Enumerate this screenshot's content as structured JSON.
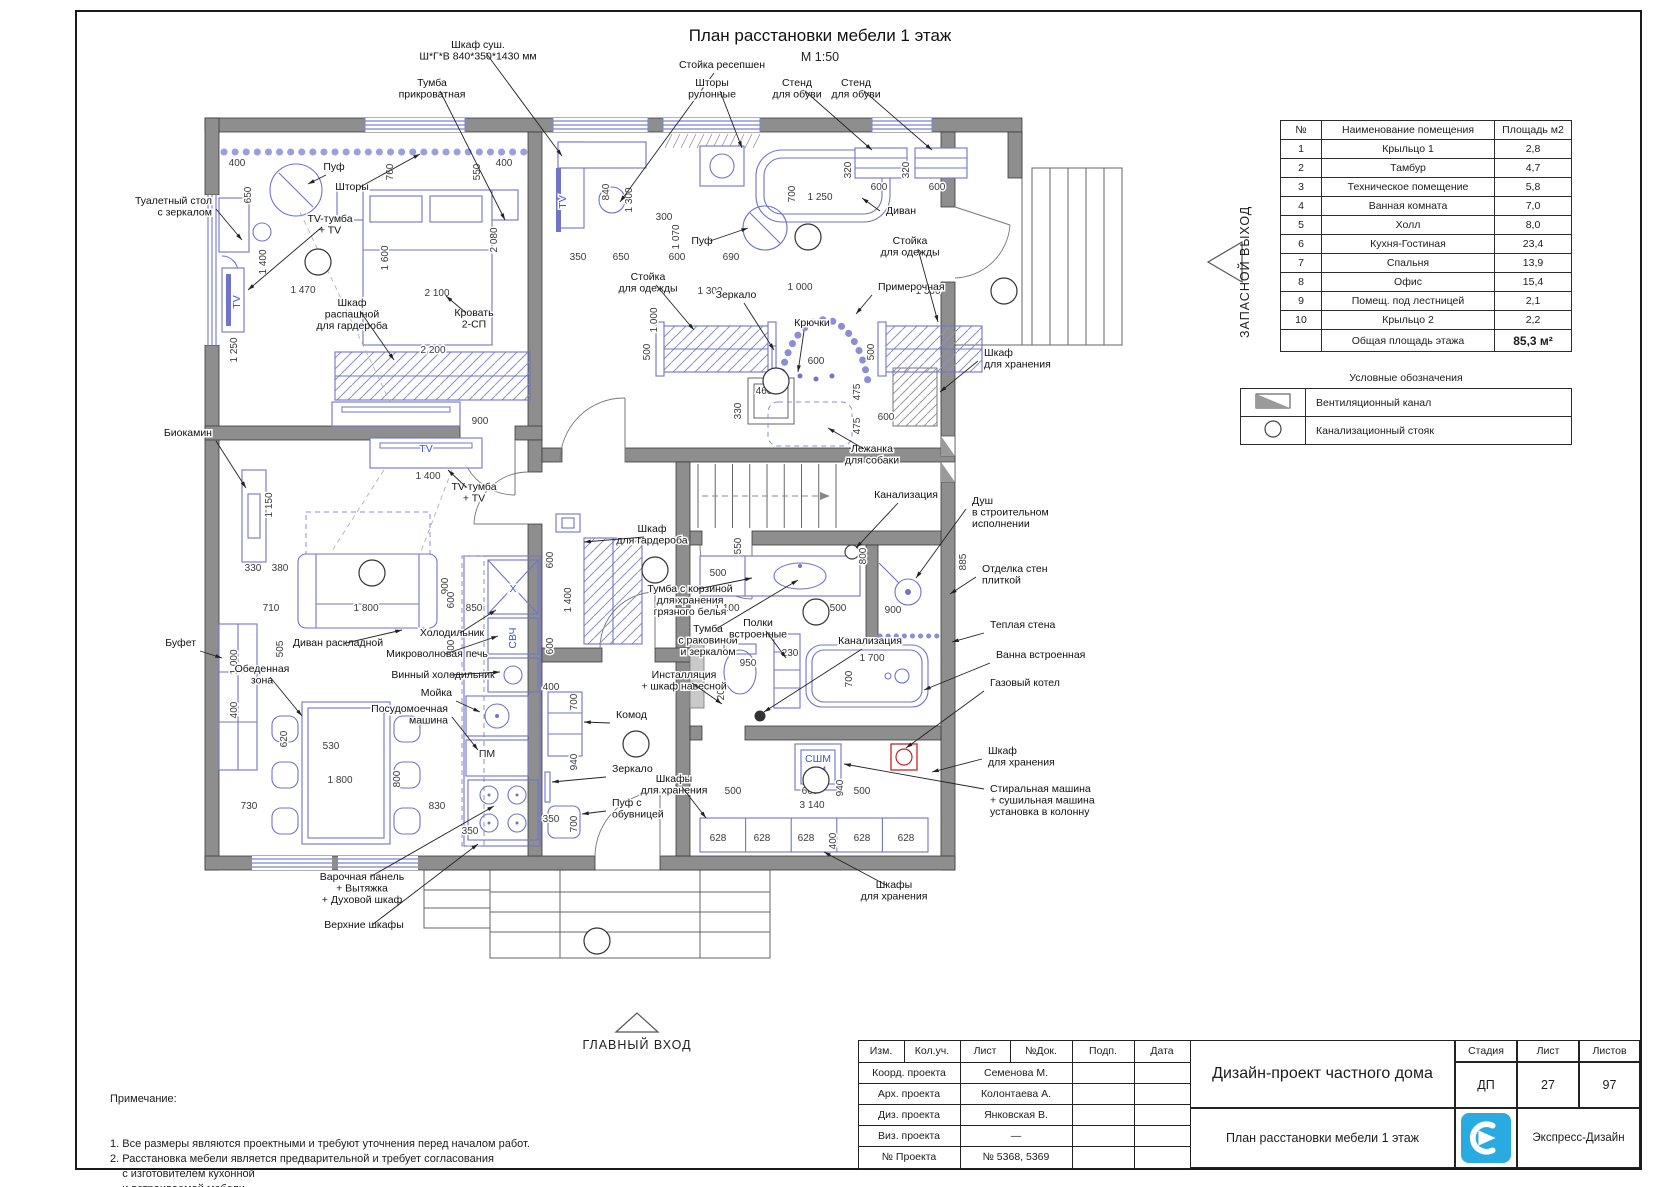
{
  "page": {
    "title": "План расстановки мебели 1 этаж",
    "scale": "М 1:50"
  },
  "arrows": {
    "main_entrance": "ГЛАВНЫЙ ВХОД",
    "emergency_exit": "ЗАПАСНОЙ ВЫХОД"
  },
  "room_table": {
    "headers": [
      "№",
      "Наименование помещения",
      "Площадь м2"
    ],
    "rows": [
      [
        "1",
        "Крыльцо 1",
        "2,8"
      ],
      [
        "2",
        "Тамбур",
        "4,7"
      ],
      [
        "3",
        "Техническое помещение",
        "5,8"
      ],
      [
        "4",
        "Ванная комната",
        "7,0"
      ],
      [
        "5",
        "Холл",
        "8,0"
      ],
      [
        "6",
        "Кухня-Гостиная",
        "23,4"
      ],
      [
        "7",
        "Спальня",
        "13,9"
      ],
      [
        "8",
        "Офис",
        "15,4"
      ],
      [
        "9",
        "Помещ. под лестницей",
        "2,1"
      ],
      [
        "10",
        "Крыльцо 2",
        "2,2"
      ]
    ],
    "total_label": "Общая площадь этажа",
    "total_value": "85,3 м²"
  },
  "legend": {
    "title": "Условные обозначения",
    "items": [
      {
        "symbol": "vent-channel",
        "label": "Вентиляционный канал"
      },
      {
        "symbol": "sewer-riser",
        "label": "Канализационный стояк"
      }
    ]
  },
  "notes": {
    "title": "Примечание:",
    "items": [
      "1. Все размеры являются проектными и требуют уточнения перед началом работ.",
      "2. Расстановка мебели является предварительной и требует согласования",
      "    с изготовителем кухонной",
      "    и встраиваемой мебели.",
      "3. Несоответствия согласовать с автором проекта."
    ]
  },
  "title_block": {
    "header_cols": [
      "Изм.",
      "Кол.уч.",
      "Лист",
      "№Док.",
      "Подп.",
      "Дата"
    ],
    "rows": [
      [
        "Коорд. проекта",
        "Семенова М."
      ],
      [
        "Арх. проекта",
        "Колонтаева А."
      ],
      [
        "Диз. проекта",
        "Янковская В."
      ],
      [
        "Виз. проекта",
        "—"
      ],
      [
        "№ Проекта",
        "№ 5368, 5369"
      ]
    ],
    "project_title": "Дизайн-проект частного дома",
    "stage_label": "Стадия",
    "stage": "ДП",
    "sheet_label": "Лист",
    "sheet": "27",
    "sheets_label": "Листов",
    "sheets": "97",
    "drawing_name": "План расстановки мебели 1 этаж",
    "company": "Экспресс-Дизайн",
    "logo_color": "#29abe2"
  },
  "plan": {
    "room_numbers": [
      {
        "n": "1",
        "x": 597,
        "y": 941
      },
      {
        "n": "2",
        "x": 636,
        "y": 744
      },
      {
        "n": "3",
        "x": 816,
        "y": 780
      },
      {
        "n": "4",
        "x": 816,
        "y": 612
      },
      {
        "n": "5",
        "x": 655,
        "y": 570
      },
      {
        "n": "6",
        "x": 372,
        "y": 573
      },
      {
        "n": "7",
        "x": 318,
        "y": 262
      },
      {
        "n": "8",
        "x": 808,
        "y": 237
      },
      {
        "n": "9",
        "x": 776,
        "y": 381
      },
      {
        "n": "10",
        "x": 1004,
        "y": 291
      }
    ],
    "labels": [
      {
        "t": "Туалетный стол\nс зеркалом",
        "x": 212,
        "y": 204,
        "a": "end",
        "tx": 242,
        "ty": 240
      },
      {
        "t": "Тумба\nприкроватная",
        "x": 432,
        "y": 86,
        "a": "middle",
        "tx": 505,
        "ty": 220
      },
      {
        "t": "Шкаф суш.\nШ*Г*В 840*350*1430 мм",
        "x": 478,
        "y": 48,
        "a": "middle",
        "tx": 562,
        "ty": 156
      },
      {
        "t": "Стойка ресепшен",
        "x": 722,
        "y": 68,
        "a": "middle",
        "tx": 620,
        "ty": 202
      },
      {
        "t": "Шторы\nрулонные",
        "x": 712,
        "y": 86,
        "a": "middle",
        "tx": 742,
        "ty": 148
      },
      {
        "t": "Стенд\nдля обуви",
        "x": 797,
        "y": 86,
        "a": "middle",
        "tx": 872,
        "ty": 150
      },
      {
        "t": "Стенд\nдля обуви",
        "x": 856,
        "y": 86,
        "a": "middle",
        "tx": 932,
        "ty": 150
      },
      {
        "t": "Пуф",
        "x": 334,
        "y": 170,
        "a": "middle",
        "tx": 308,
        "ty": 184
      },
      {
        "t": "Шторы",
        "x": 352,
        "y": 190,
        "a": "middle",
        "tx": 420,
        "ty": 154
      },
      {
        "t": "TV-тумба\n+ TV",
        "x": 330,
        "y": 222,
        "a": "middle",
        "tx": 248,
        "ty": 290
      },
      {
        "t": "Кровать\n2-СП",
        "x": 474,
        "y": 316,
        "a": "middle",
        "tx": 446,
        "ty": 296
      },
      {
        "t": "Шкаф\nраспашной\nдля гардероба",
        "x": 352,
        "y": 306,
        "a": "middle",
        "tx": 394,
        "ty": 360
      },
      {
        "t": "Пуф",
        "x": 702,
        "y": 244,
        "a": "middle",
        "tx": 748,
        "ty": 228
      },
      {
        "t": "Диван",
        "x": 886,
        "y": 214,
        "a": "start",
        "tx": 862,
        "ty": 198
      },
      {
        "t": "Стойка\nдля одежды",
        "x": 648,
        "y": 280,
        "a": "middle",
        "tx": 694,
        "ty": 330
      },
      {
        "t": "Зеркало",
        "x": 736,
        "y": 298,
        "a": "middle",
        "tx": 774,
        "ty": 350
      },
      {
        "t": "Крючки",
        "x": 812,
        "y": 326,
        "a": "middle",
        "tx": 798,
        "ty": 372
      },
      {
        "t": "Примерочная",
        "x": 878,
        "y": 290,
        "a": "start",
        "tx": 856,
        "ty": 314
      },
      {
        "t": "Стойка\nдля одежды",
        "x": 910,
        "y": 244,
        "a": "middle",
        "tx": 938,
        "ty": 322
      },
      {
        "t": "Шкаф\nдля хранения",
        "x": 984,
        "y": 356,
        "a": "start",
        "tx": 940,
        "ty": 392
      },
      {
        "t": "Лежанка\nдля собаки",
        "x": 872,
        "y": 452,
        "a": "middle",
        "tx": 828,
        "ty": 428
      },
      {
        "t": "Канализация",
        "x": 906,
        "y": 498,
        "a": "middle",
        "tx": 856,
        "ty": 548
      },
      {
        "t": "Душ\nв строительном\nисполнении",
        "x": 972,
        "y": 504,
        "a": "start",
        "tx": 916,
        "ty": 578
      },
      {
        "t": "Отделка стен\nплиткой",
        "x": 982,
        "y": 572,
        "a": "start",
        "tx": 950,
        "ty": 594
      },
      {
        "t": "Теплая стена",
        "x": 990,
        "y": 628,
        "a": "start",
        "tx": 952,
        "ty": 642
      },
      {
        "t": "Ванна встроенная",
        "x": 996,
        "y": 658,
        "a": "start",
        "tx": 924,
        "ty": 690
      },
      {
        "t": "Газовый котел",
        "x": 990,
        "y": 686,
        "a": "start",
        "tx": 906,
        "ty": 748
      },
      {
        "t": "Шкаф\nдля хранения",
        "x": 988,
        "y": 754,
        "a": "start",
        "tx": 932,
        "ty": 772
      },
      {
        "t": "Стиральная машина\n+ сушильная машина\nустановка в колонну",
        "x": 990,
        "y": 792,
        "a": "start",
        "tx": 844,
        "ty": 764
      },
      {
        "t": "Шкафы\nдля хранения",
        "x": 894,
        "y": 888,
        "a": "middle",
        "tx": 824,
        "ty": 852
      },
      {
        "t": "Шкафы\nдля хранения",
        "x": 674,
        "y": 782,
        "a": "middle",
        "tx": 706,
        "ty": 818
      },
      {
        "t": "Зеркало",
        "x": 612,
        "y": 772,
        "a": "start",
        "tx": 552,
        "ty": 782
      },
      {
        "t": "Комод",
        "x": 616,
        "y": 718,
        "a": "start",
        "tx": 584,
        "ty": 722
      },
      {
        "t": "Пуф с\nобувницей",
        "x": 612,
        "y": 806,
        "a": "start",
        "tx": 582,
        "ty": 814
      },
      {
        "t": "Шкаф\nдля гардероба",
        "x": 652,
        "y": 532,
        "a": "middle",
        "tx": 584,
        "ty": 542
      },
      {
        "t": "Тумба с корзиной\nдля хранения\nгрязного белья",
        "x": 690,
        "y": 592,
        "a": "middle",
        "tx": 752,
        "ty": 578
      },
      {
        "t": "Тумба\nс раковиной\nи зеркалом",
        "x": 708,
        "y": 632,
        "a": "middle",
        "tx": 798,
        "ty": 580
      },
      {
        "t": "Инсталляция\n+ шкаф навесной",
        "x": 684,
        "y": 678,
        "a": "middle",
        "tx": 722,
        "ty": 704
      },
      {
        "t": "Полки\nвстроенные",
        "x": 758,
        "y": 626,
        "a": "middle",
        "tx": 786,
        "ty": 658
      },
      {
        "t": "Канализация",
        "x": 870,
        "y": 644,
        "a": "middle",
        "tx": 764,
        "ty": 712
      },
      {
        "t": "Биокамин",
        "x": 212,
        "y": 436,
        "a": "end",
        "tx": 246,
        "ty": 488
      },
      {
        "t": "Буфет",
        "x": 196,
        "y": 646,
        "a": "end",
        "tx": 222,
        "ty": 658
      },
      {
        "t": "Обеденная\nзона",
        "x": 262,
        "y": 672,
        "a": "middle",
        "tx": 302,
        "ty": 716
      },
      {
        "t": "Диван раскладной",
        "x": 338,
        "y": 646,
        "a": "middle",
        "tx": 402,
        "ty": 630
      },
      {
        "t": "Холодильник",
        "x": 452,
        "y": 636,
        "a": "middle",
        "tx": 496,
        "ty": 610
      },
      {
        "t": "Микроволновая печь",
        "x": 437,
        "y": 657,
        "a": "middle",
        "tx": 498,
        "ty": 636
      },
      {
        "t": "Винный холодильник",
        "x": 443,
        "y": 678,
        "a": "middle",
        "tx": 500,
        "ty": 672
      },
      {
        "t": "Мойка",
        "x": 452,
        "y": 696,
        "a": "end",
        "tx": 480,
        "ty": 712
      },
      {
        "t": "Посудомоечная\nмашина",
        "x": 448,
        "y": 712,
        "a": "end",
        "tx": 478,
        "ty": 750
      },
      {
        "t": "Варочная панель\n+ Вытяжка\n+ Духовой шкаф",
        "x": 362,
        "y": 880,
        "a": "middle",
        "tx": 494,
        "ty": 806
      },
      {
        "t": "Верхние шкафы",
        "x": 364,
        "y": 928,
        "a": "middle",
        "tx": 478,
        "ty": 844
      },
      {
        "t": "TV-тумба\n+ TV",
        "x": 474,
        "y": 490,
        "a": "middle",
        "tx": 448,
        "ty": 470
      }
    ],
    "dims": [
      [
        "400",
        237,
        166
      ],
      [
        "650",
        251,
        195,
        1
      ],
      [
        "1 400",
        266,
        262,
        1
      ],
      [
        "1 470",
        303,
        293
      ],
      [
        "2 100",
        437,
        296
      ],
      [
        "1 600",
        388,
        258,
        1
      ],
      [
        "2 200",
        433,
        353
      ],
      [
        "760",
        393,
        172,
        1
      ],
      [
        "550",
        480,
        172,
        1
      ],
      [
        "2 080",
        497,
        240,
        1
      ],
      [
        "400",
        504,
        166
      ],
      [
        "840",
        609,
        192,
        1
      ],
      [
        "1 300",
        632,
        200,
        1
      ],
      [
        "300",
        664,
        220
      ],
      [
        "350",
        578,
        260
      ],
      [
        "650",
        621,
        260
      ],
      [
        "600",
        677,
        260
      ],
      [
        "690",
        731,
        260
      ],
      [
        "320",
        851,
        170,
        1
      ],
      [
        "600",
        879,
        190
      ],
      [
        "320",
        909,
        170,
        1
      ],
      [
        "600",
        937,
        190
      ],
      [
        "700",
        795,
        194,
        1
      ],
      [
        "1 250",
        820,
        200
      ],
      [
        "1 070",
        679,
        237,
        1
      ],
      [
        "1 000",
        800,
        290
      ],
      [
        "1 300",
        710,
        294
      ],
      [
        "1 300",
        928,
        294
      ],
      [
        "500",
        650,
        352,
        1
      ],
      [
        "500",
        874,
        352,
        1
      ],
      [
        "1 000",
        657,
        320,
        1
      ],
      [
        "600",
        816,
        364
      ],
      [
        "460",
        764,
        394
      ],
      [
        "330",
        741,
        411,
        1
      ],
      [
        "475",
        860,
        392,
        1
      ],
      [
        "475",
        860,
        426,
        1
      ],
      [
        "600",
        886,
        420
      ],
      [
        "1 250",
        237,
        350,
        1
      ],
      [
        "1 150",
        272,
        505,
        1
      ],
      [
        "330",
        253,
        571
      ],
      [
        "380",
        280,
        571
      ],
      [
        "710",
        271,
        611
      ],
      [
        "1 800",
        366,
        611
      ],
      [
        "850",
        474,
        611
      ],
      [
        "900",
        448,
        586,
        1
      ],
      [
        "505",
        283,
        649,
        1
      ],
      [
        "1 000",
        237,
        662,
        1
      ],
      [
        "400",
        237,
        710,
        1
      ],
      [
        "620",
        287,
        739,
        1
      ],
      [
        "530",
        331,
        749
      ],
      [
        "1 800",
        340,
        783
      ],
      [
        "800",
        400,
        779,
        1
      ],
      [
        "730",
        249,
        809
      ],
      [
        "830",
        437,
        809
      ],
      [
        "350",
        470,
        834
      ],
      [
        "900",
        480,
        424
      ],
      [
        "1 400",
        428,
        479
      ],
      [
        "600",
        454,
        600,
        1
      ],
      [
        "600",
        454,
        648,
        1
      ],
      [
        "600",
        553,
        560,
        1
      ],
      [
        "1 400",
        571,
        600,
        1
      ],
      [
        "600",
        553,
        646,
        1
      ],
      [
        "400",
        551,
        690
      ],
      [
        "700",
        577,
        702,
        1
      ],
      [
        "940",
        577,
        762,
        1
      ],
      [
        "350",
        551,
        822
      ],
      [
        "700",
        577,
        824,
        1
      ],
      [
        "500",
        718,
        576
      ],
      [
        "550",
        741,
        546,
        1
      ],
      [
        "1 100",
        727,
        611
      ],
      [
        "500",
        838,
        611
      ],
      [
        "800",
        866,
        556,
        1
      ],
      [
        "900",
        893,
        613
      ],
      [
        "885",
        966,
        562,
        1
      ],
      [
        "230",
        790,
        656
      ],
      [
        "950",
        748,
        666
      ],
      [
        "200",
        724,
        692,
        1
      ],
      [
        "1 700",
        872,
        661
      ],
      [
        "700",
        852,
        679,
        1
      ],
      [
        "500",
        733,
        794
      ],
      [
        "660",
        810,
        794
      ],
      [
        "500",
        862,
        794
      ],
      [
        "940",
        843,
        788,
        1
      ],
      [
        "3 140",
        812,
        808
      ],
      [
        "628",
        718,
        841
      ],
      [
        "628",
        762,
        841
      ],
      [
        "628",
        806,
        841
      ],
      [
        "400",
        836,
        841,
        1
      ],
      [
        "628",
        862,
        841
      ],
      [
        "628",
        906,
        841
      ]
    ],
    "texts": [
      {
        "t": "TV",
        "x": 240,
        "y": 302,
        "r": 1,
        "c": 1
      },
      {
        "t": "TV",
        "x": 426,
        "y": 452,
        "c": 1
      },
      {
        "t": "TV",
        "x": 566,
        "y": 202,
        "r": 1,
        "c": 1
      },
      {
        "t": "X",
        "x": 513,
        "y": 592,
        "c": 1
      },
      {
        "t": "СВЧ",
        "x": 516,
        "y": 638,
        "r": 1,
        "c": 1
      },
      {
        "t": "ПМ",
        "x": 487,
        "y": 757
      },
      {
        "t": "СШМ\nСМ",
        "x": 818,
        "y": 762,
        "c": 1
      }
    ]
  }
}
